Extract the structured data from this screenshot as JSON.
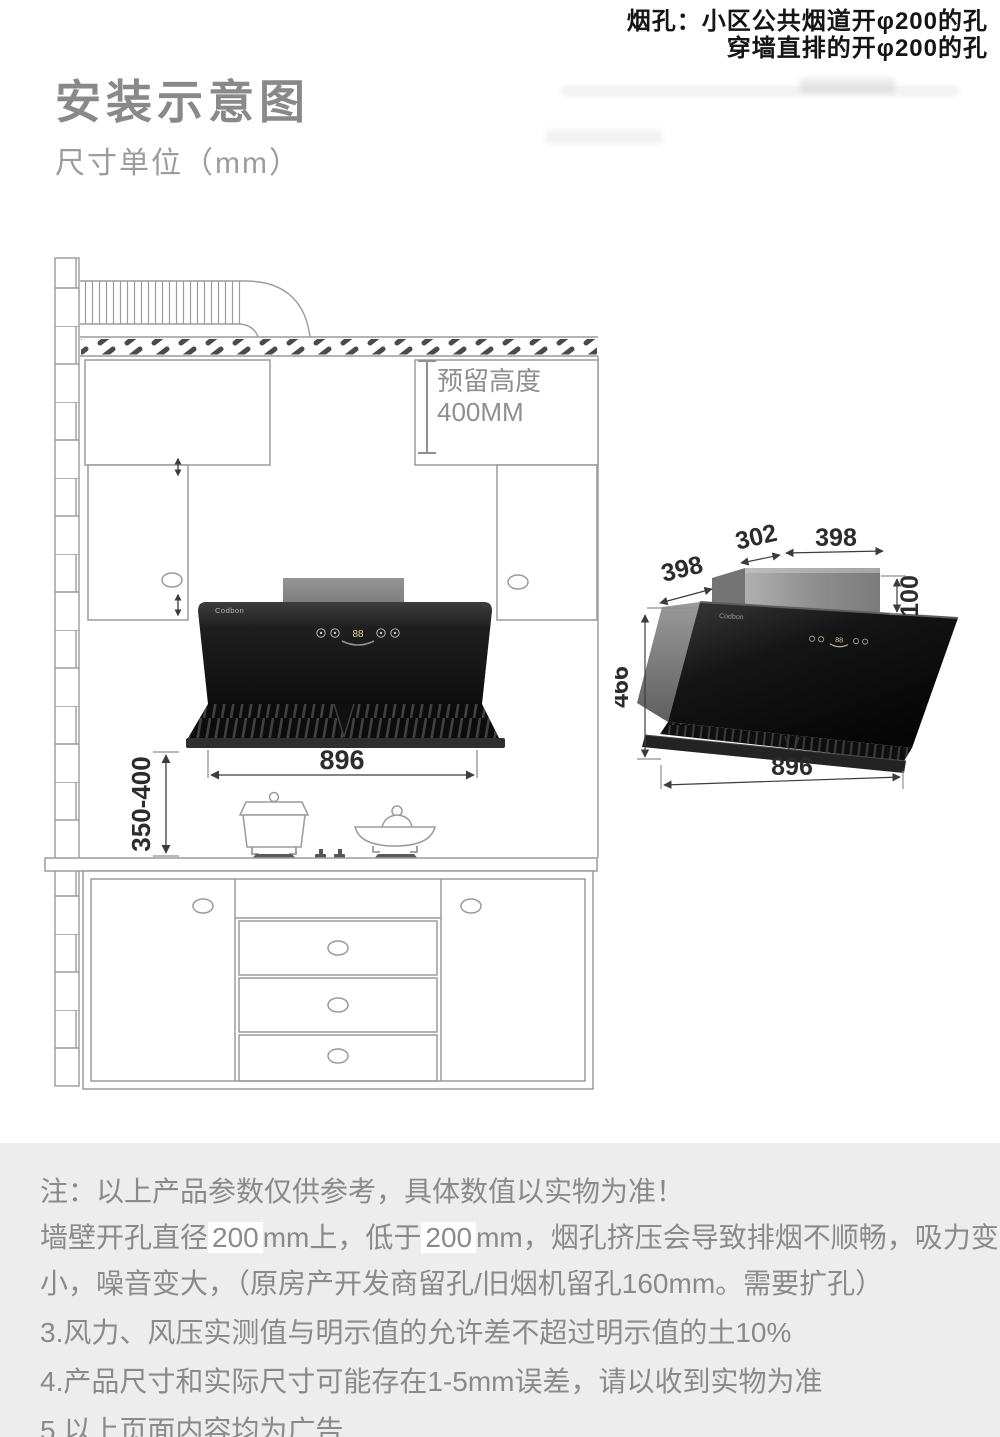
{
  "header": {
    "duct_note_line1": "烟孔：小区公共烟道开φ200的孔",
    "duct_note_line2": "穿墙直排的开φ200的孔",
    "title": "安装示意图",
    "subtitle": "尺寸单位（mm）"
  },
  "kitchen_view": {
    "reserved_height_line1": "预留高度",
    "reserved_height_line2": "400MM",
    "hood_width": "896",
    "install_height": "350-400",
    "brand": "Codbon",
    "display": "88"
  },
  "product_view": {
    "brand": "Codbon",
    "top_depth": "398",
    "duct_depth": "302",
    "duct_width": "398",
    "duct_height": "100",
    "body_height": "466",
    "body_width": "896",
    "display": "88"
  },
  "notes": {
    "line1": "注：以上产品参数仅供参考，具体数值以实物为准！",
    "line2_prefix": "墙壁开孔直径",
    "line2_value1": "200",
    "line2_mid": "mm上，低于",
    "line2_value2": "200",
    "line2_suffix": "mm，烟孔挤压会导致排烟不顺畅，吸力变",
    "line3": "小，噪音变大，（原房产开发商留孔/旧烟机留孔160mm。需要扩孔）",
    "line4": "3.风力、风压实测值与明示值的允许差不超过明示值的土10%",
    "line5": "4.产品尺寸和实际尺寸可能存在1-5mm误差，请以收到实物为准",
    "line6": "5.以上页面内容均为广告"
  },
  "colors": {
    "line_gray": "#9b9b9b",
    "accent_gray": "#8f8f8f",
    "dim_text": "#2c2c2c",
    "hood_black": "#111111",
    "panel_bg": "#ededed"
  }
}
